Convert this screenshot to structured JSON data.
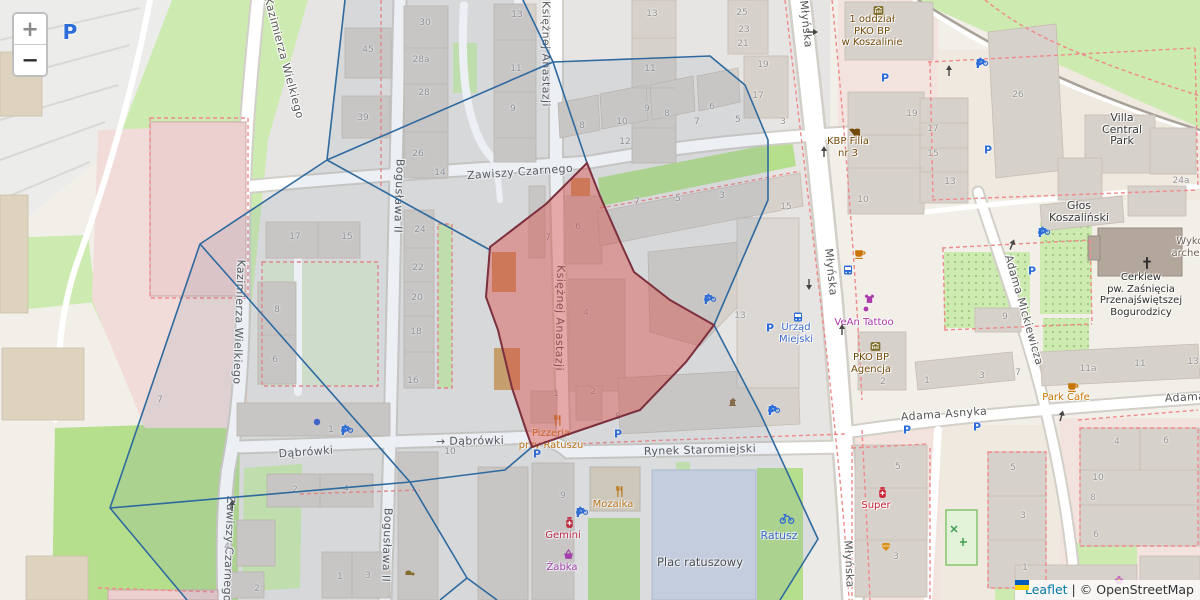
{
  "attribution": {
    "leaflet": "Leaflet",
    "separator": "|",
    "osm": "© OpenStreetMap"
  },
  "controls": {
    "zoom_in": "+",
    "zoom_out": "−"
  },
  "colors": {
    "highlight_fill": "rgba(217,72,65,0.42)",
    "highlight_border": "#7c2f3e",
    "voronoi_line": "#2f6a9e",
    "parking_blue": "#2b6cd9",
    "shop_purple": "#ac39ac",
    "food_orange": "#c77400",
    "health_red": "#cc2233",
    "amenity_brown": "#734a08",
    "transit_blue": "#3b6acb",
    "leaflet_link": "#0078a8"
  },
  "street_labels": [
    {
      "t": "Kazimierza Wielkiego",
      "x": 284,
      "y": 58,
      "r": 75
    },
    {
      "t": "Kazimierza Wielkiego",
      "x": 239,
      "y": 322,
      "r": 92
    },
    {
      "t": "Bogusława II",
      "x": 399,
      "y": 196,
      "r": 92
    },
    {
      "t": "Bogusława II",
      "x": 387,
      "y": 545,
      "r": 92
    },
    {
      "t": "Księżnej Anastazji",
      "x": 546,
      "y": 54,
      "r": 90
    },
    {
      "t": "Księżnej Anastazji",
      "x": 560,
      "y": 318,
      "r": 91
    },
    {
      "t": "Zawiszy Czarnego",
      "x": 520,
      "y": 172,
      "r": -4
    },
    {
      "t": "Zawiszy Czarnego",
      "x": 229,
      "y": 549,
      "r": 92
    },
    {
      "t": "Młyńska",
      "x": 806,
      "y": 24,
      "r": 84
    },
    {
      "t": "Młyńska",
      "x": 831,
      "y": 272,
      "r": 84
    },
    {
      "t": "Młyńska",
      "x": 849,
      "y": 564,
      "r": 87
    },
    {
      "t": "Dąbrówki",
      "x": 306,
      "y": 452,
      "r": -4
    },
    {
      "t": "→ Dąbrówki",
      "x": 470,
      "y": 441,
      "r": -1
    },
    {
      "t": "Rynek Staromiejski",
      "x": 700,
      "y": 450,
      "r": -1.5
    },
    {
      "t": "Adama Asnyka",
      "x": 944,
      "y": 414,
      "r": -4
    },
    {
      "t": "Adama Asnyka",
      "x": 1208,
      "y": 396,
      "r": -3
    },
    {
      "t": "Adama Mickiewicza",
      "x": 1024,
      "y": 310,
      "r": 74
    }
  ],
  "poi_labels": [
    {
      "lines": [
        "1 oddział",
        "PKO BP",
        "w Koszalinie"
      ],
      "x": 872,
      "y": 14,
      "c": "#734a08"
    },
    {
      "lines": [
        "KBP Filia",
        "nr 3"
      ],
      "x": 848,
      "y": 136,
      "c": "#734a08"
    },
    {
      "lines": [
        "Villa",
        "Central",
        "Park"
      ],
      "x": 1122,
      "y": 112,
      "c": "#3a3a3a",
      "s": 11
    },
    {
      "lines": [
        "Głos",
        "Koszaliński"
      ],
      "x": 1079,
      "y": 200,
      "c": "#3a3a3a",
      "s": 11
    },
    {
      "lines": [
        "Wykop",
        "archeolo"
      ],
      "x": 1193,
      "y": 236,
      "c": "#6e6255"
    },
    {
      "lines": [
        "Cerkiew",
        "pw. Zaśnięcia",
        "Przenajświętszej",
        "Bogurodzicy"
      ],
      "x": 1141,
      "y": 272,
      "c": "#2e2e2e"
    },
    {
      "lines": [
        "Park Cafe"
      ],
      "x": 1066,
      "y": 392,
      "c": "#c77400"
    },
    {
      "lines": [
        "VeAn Tattoo"
      ],
      "x": 864,
      "y": 317,
      "c": "#ac39ac"
    },
    {
      "lines": [
        "PKO BP",
        "Agencja"
      ],
      "x": 871,
      "y": 352,
      "c": "#734a08"
    },
    {
      "lines": [
        "Urząd",
        "Miejski"
      ],
      "x": 796,
      "y": 322,
      "c": "#3b6acb"
    },
    {
      "lines": [
        "Pizzeria",
        "przy Ratuszu"
      ],
      "x": 551,
      "y": 428,
      "c": "#c77400"
    },
    {
      "lines": [
        "Mozaika"
      ],
      "x": 613,
      "y": 499,
      "c": "#c77400"
    },
    {
      "lines": [
        "Gemini"
      ],
      "x": 563,
      "y": 530,
      "c": "#cc2233"
    },
    {
      "lines": [
        "Żabka"
      ],
      "x": 562,
      "y": 562,
      "c": "#ac39ac"
    },
    {
      "lines": [
        "Plac ratuszowy"
      ],
      "x": 700,
      "y": 557,
      "c": "#4a4a4a",
      "s": 11.5
    },
    {
      "lines": [
        "Ratusz"
      ],
      "x": 779,
      "y": 530,
      "c": "#3b6acb",
      "s": 11
    },
    {
      "lines": [
        "Super"
      ],
      "x": 876,
      "y": 500,
      "c": "#cc2233"
    }
  ],
  "building_numbers": [
    [
      "45",
      368,
      50
    ],
    [
      "39",
      363,
      118
    ],
    [
      "30",
      425,
      23
    ],
    [
      "28a",
      421,
      60
    ],
    [
      "28",
      424,
      93
    ],
    [
      "26",
      418,
      154
    ],
    [
      "14",
      440,
      173
    ],
    [
      "17",
      295,
      237
    ],
    [
      "15",
      347,
      237
    ],
    [
      "8",
      277,
      310
    ],
    [
      "6",
      275,
      360
    ],
    [
      "7",
      160,
      400
    ],
    [
      "24",
      420,
      230
    ],
    [
      "22",
      418,
      268
    ],
    [
      "20",
      417,
      298
    ],
    [
      "18",
      416,
      332
    ],
    [
      "16",
      413,
      381
    ],
    [
      "13",
      517,
      15
    ],
    [
      "11",
      516,
      69
    ],
    [
      "9",
      513,
      109
    ],
    [
      "13",
      652,
      14
    ],
    [
      "11",
      650,
      69
    ],
    [
      "9",
      647,
      109
    ],
    [
      "12",
      625,
      142
    ],
    [
      "8",
      582,
      126
    ],
    [
      "10",
      622,
      122
    ],
    [
      "8",
      667,
      114
    ],
    [
      "6",
      712,
      107
    ],
    [
      "25",
      742,
      13
    ],
    [
      "23",
      744,
      30
    ],
    [
      "21",
      743,
      44
    ],
    [
      "19",
      763,
      65
    ],
    [
      "17",
      758,
      96
    ],
    [
      "7",
      697,
      122
    ],
    [
      "5",
      738,
      120
    ],
    [
      "3",
      783,
      122
    ],
    [
      "7",
      637,
      202
    ],
    [
      "5",
      678,
      199
    ],
    [
      "3",
      722,
      196
    ],
    [
      "15",
      786,
      207
    ],
    [
      "7",
      548,
      238
    ],
    [
      "6",
      578,
      227
    ],
    [
      "4",
      586,
      313
    ],
    [
      "2",
      593,
      392
    ],
    [
      "1",
      556,
      394
    ],
    [
      "13",
      740,
      316
    ],
    [
      "10",
      863,
      200
    ],
    [
      "2",
      883,
      382
    ],
    [
      "19",
      912,
      114
    ],
    [
      "17",
      933,
      129
    ],
    [
      "15",
      933,
      154
    ],
    [
      "13",
      950,
      182
    ],
    [
      "26",
      1018,
      95
    ],
    [
      "24a",
      1181,
      181
    ],
    [
      "9",
      1005,
      317
    ],
    [
      "7",
      1018,
      373
    ],
    [
      "3",
      982,
      376
    ],
    [
      "1",
      927,
      381
    ],
    [
      "11a",
      1088,
      369
    ],
    [
      "11",
      1140,
      364
    ],
    [
      "13",
      1193,
      362
    ],
    [
      "5",
      898,
      467
    ],
    [
      "3",
      896,
      557
    ],
    [
      "5",
      1013,
      468
    ],
    [
      "3",
      1023,
      516
    ],
    [
      "1",
      1025,
      568
    ],
    [
      "4",
      1117,
      442
    ],
    [
      "6",
      1166,
      441
    ],
    [
      "10",
      1098,
      478
    ],
    [
      "8",
      1093,
      498
    ],
    [
      "6",
      1096,
      535
    ],
    [
      "2",
      295,
      490
    ],
    [
      "4",
      346,
      489
    ],
    [
      "4",
      227,
      547
    ],
    [
      "2",
      257,
      589
    ],
    [
      "1",
      340,
      577
    ],
    [
      "3",
      368,
      576
    ],
    [
      "10",
      450,
      452
    ],
    [
      "8",
      618,
      417
    ],
    [
      "9",
      563,
      496
    ],
    [
      "1",
      331,
      430
    ]
  ],
  "parking": [
    {
      "x": 70,
      "y": 32,
      "s": 20,
      "bike": false
    },
    {
      "x": 980,
      "y": 64,
      "s": 12,
      "bike": true
    },
    {
      "x": 885,
      "y": 78,
      "s": 11,
      "bike": false
    },
    {
      "x": 988,
      "y": 150,
      "s": 11,
      "bike": false
    },
    {
      "x": 1042,
      "y": 233,
      "s": 12,
      "bike": true
    },
    {
      "x": 1032,
      "y": 271,
      "s": 11,
      "bike": false
    },
    {
      "x": 708,
      "y": 300,
      "s": 12,
      "bike": true
    },
    {
      "x": 770,
      "y": 328,
      "s": 11,
      "bike": false
    },
    {
      "x": 772,
      "y": 411,
      "s": 12,
      "bike": true
    },
    {
      "x": 618,
      "y": 434,
      "s": 11,
      "bike": false
    },
    {
      "x": 537,
      "y": 454,
      "s": 11,
      "bike": false
    },
    {
      "x": 580,
      "y": 513,
      "s": 12,
      "bike": true
    },
    {
      "x": 345,
      "y": 431,
      "s": 12,
      "bike": true
    },
    {
      "x": 907,
      "y": 430,
      "s": 11,
      "bike": false
    },
    {
      "x": 977,
      "y": 427,
      "s": 11,
      "bike": false
    }
  ],
  "icons": [
    {
      "t": "restaurant",
      "x": 551,
      "y": 414,
      "c": "#c77400"
    },
    {
      "t": "restaurant",
      "x": 613,
      "y": 485,
      "c": "#c77400"
    },
    {
      "t": "cafe",
      "x": 1066,
      "y": 380,
      "c": "#c77400"
    },
    {
      "t": "cafe",
      "x": 853,
      "y": 247,
      "c": "#c77400"
    },
    {
      "t": "pharmacy",
      "x": 563,
      "y": 516,
      "c": "#cc2233"
    },
    {
      "t": "pharmacy",
      "x": 876,
      "y": 486,
      "c": "#cc2233"
    },
    {
      "t": "basket",
      "x": 562,
      "y": 548,
      "c": "#ac39ac"
    },
    {
      "t": "clothes",
      "x": 863,
      "y": 292,
      "c": "#ac39ac"
    },
    {
      "t": "dot-small",
      "x": 863,
      "y": 306,
      "c": "#ac39ac"
    },
    {
      "t": "bank",
      "x": 872,
      "y": 4,
      "c": "#7f6e28"
    },
    {
      "t": "bank",
      "x": 869,
      "y": 340,
      "c": "#7f6e28"
    },
    {
      "t": "book",
      "x": 848,
      "y": 126,
      "c": "#734a08"
    },
    {
      "t": "cross",
      "x": 1140,
      "y": 256,
      "c": "#2b2b2b"
    },
    {
      "t": "bus",
      "x": 792,
      "y": 311,
      "c": "#2b6cd9"
    },
    {
      "t": "bus",
      "x": 842,
      "y": 264,
      "c": "#2b6cd9"
    },
    {
      "t": "bike-rental",
      "x": 779,
      "y": 513,
      "c": "#2b6cd9"
    },
    {
      "t": "water",
      "x": 995,
      "y": 433,
      "c": "#3b7ad9"
    },
    {
      "t": "jewelry",
      "x": 880,
      "y": 541,
      "c": "#d98e16"
    },
    {
      "t": "flower",
      "x": 1113,
      "y": 574,
      "c": "#c06ac0"
    },
    {
      "t": "flame",
      "x": 195,
      "y": 265,
      "c": "#b06a1e"
    },
    {
      "t": "monument",
      "x": 727,
      "y": 396,
      "c": "#8a6a42"
    },
    {
      "t": "shop",
      "x": 403,
      "y": 566,
      "c": "#8a6a1e"
    },
    {
      "t": "dot",
      "x": 313,
      "y": 418,
      "c": "#3a5fcd"
    },
    {
      "t": "arrow",
      "x": 806,
      "y": 28,
      "r": 0
    },
    {
      "t": "arrow",
      "x": 820,
      "y": 158,
      "r": -90
    },
    {
      "t": "arrow",
      "x": 813,
      "y": 278,
      "r": 90
    },
    {
      "t": "arrow",
      "x": 838,
      "y": 336,
      "r": -90
    },
    {
      "t": "arrow",
      "x": 1006,
      "y": 249,
      "r": -68
    },
    {
      "t": "arrow",
      "x": 1056,
      "y": 421,
      "r": -75
    },
    {
      "t": "arrow",
      "x": 228,
      "y": 512,
      "r": -90
    },
    {
      "t": "arrow",
      "x": 945,
      "y": 77,
      "r": -90
    }
  ]
}
